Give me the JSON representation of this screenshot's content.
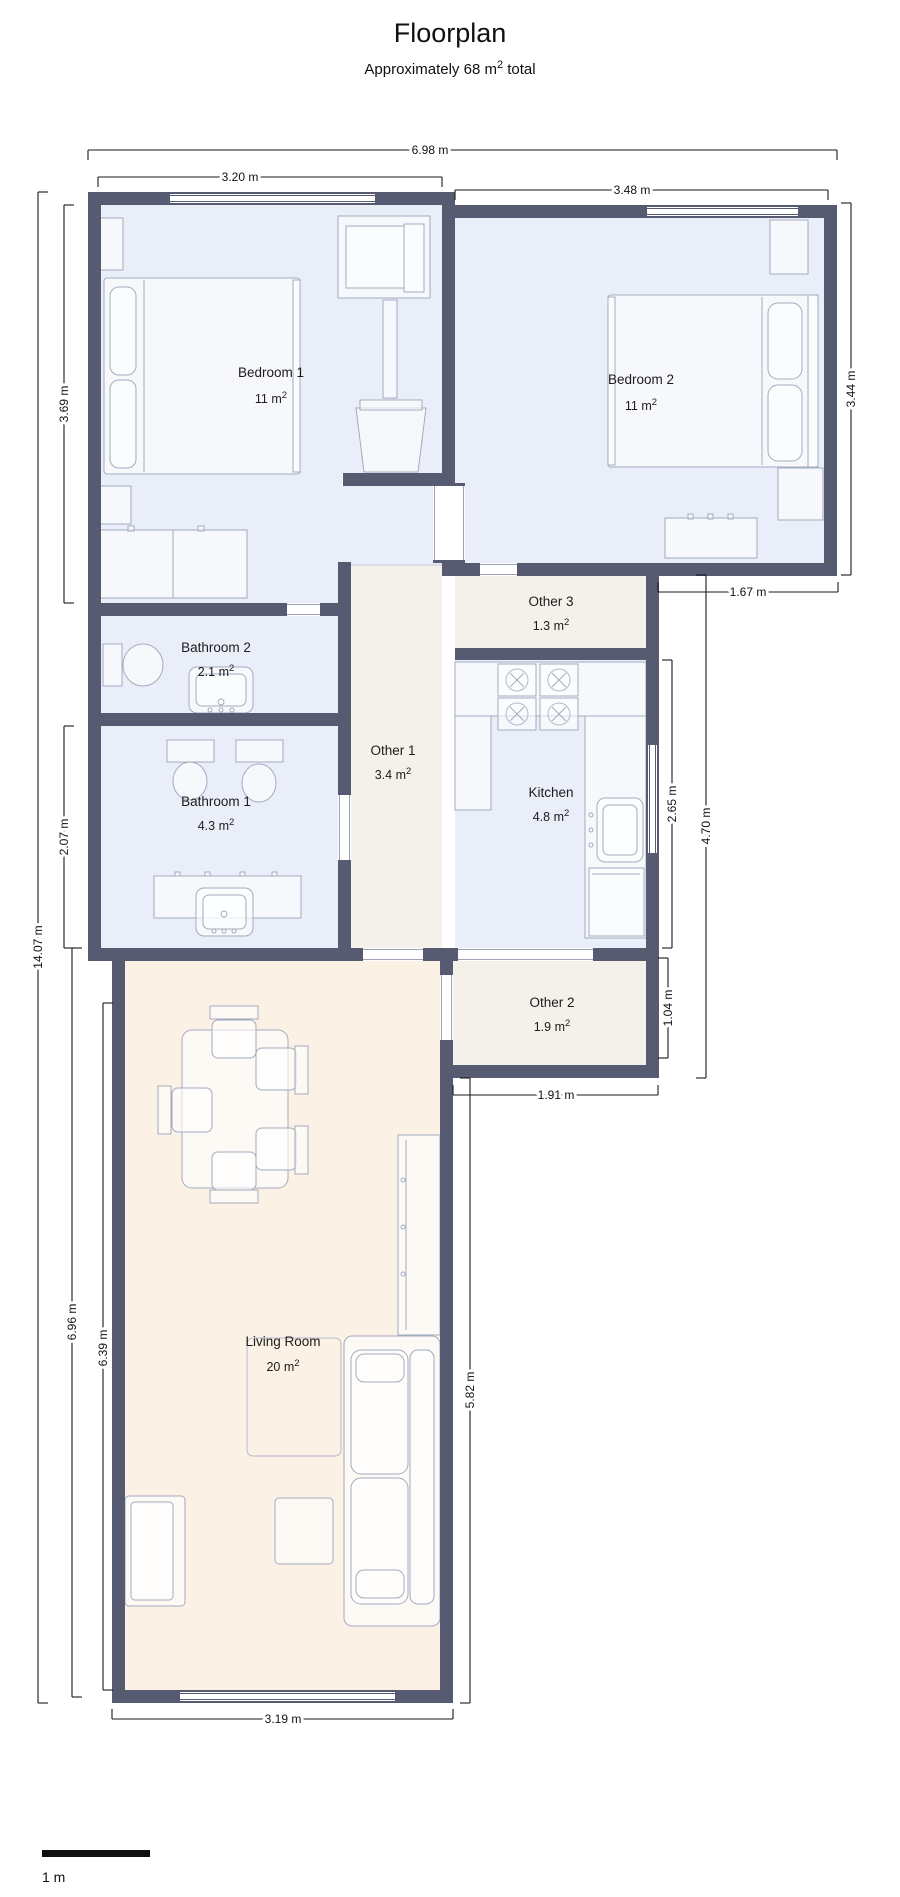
{
  "header": {
    "title": "Floorplan",
    "subtitle_prefix": "Approximately 68 m",
    "subtitle_sup": "2",
    "subtitle_suffix": " total"
  },
  "scale_bar": {
    "label": "1 m"
  },
  "superscript": "2",
  "rooms": [
    {
      "name": "Bedroom 1",
      "area": "11 m²",
      "area_base": "11 m"
    },
    {
      "name": "Bedroom 2",
      "area": "11 m²",
      "area_base": "11 m"
    },
    {
      "name": "Bathroom 2",
      "area": "2.1 m²",
      "area_base": "2.1 m"
    },
    {
      "name": "Bathroom 1",
      "area": "4.3 m²",
      "area_base": "4.3 m"
    },
    {
      "name": "Other 1",
      "area": "3.4 m²",
      "area_base": "3.4 m"
    },
    {
      "name": "Other 3",
      "area": "1.3 m²",
      "area_base": "1.3 m"
    },
    {
      "name": "Kitchen",
      "area": "4.8 m²",
      "area_base": "4.8 m"
    },
    {
      "name": "Other 2",
      "area": "1.9 m²",
      "area_base": "1.9 m"
    },
    {
      "name": "Living Room",
      "area": "20 m²",
      "area_base": "20 m"
    }
  ],
  "dimensions": {
    "overall_width": "6.98 m",
    "bedroom1_width": "3.20 m",
    "bedroom2_width": "3.48 m",
    "bedroom1_height": "3.69 m",
    "bedroom2_height": "3.44 m",
    "overall_height": "14.07 m",
    "bedroom2_step_width": "1.67 m",
    "bathroom1_height": "2.07 m",
    "kitchen_height": "2.65 m",
    "right_block_height": "4.70 m",
    "living_outer_height": "6.96 m",
    "living_inner_height": "6.39 m",
    "other2_height": "1.04 m",
    "other2_width": "1.91 m",
    "living_right_height": "5.82 m",
    "living_width": "3.19 m"
  },
  "colors": {
    "wall": "#565b72",
    "room_blue": "#e9eef8",
    "room_cream": "#f4f1ea",
    "room_peach": "#fbf1e4",
    "furniture_stroke": "#a3abbf",
    "dimension": "#1a1a1a"
  }
}
